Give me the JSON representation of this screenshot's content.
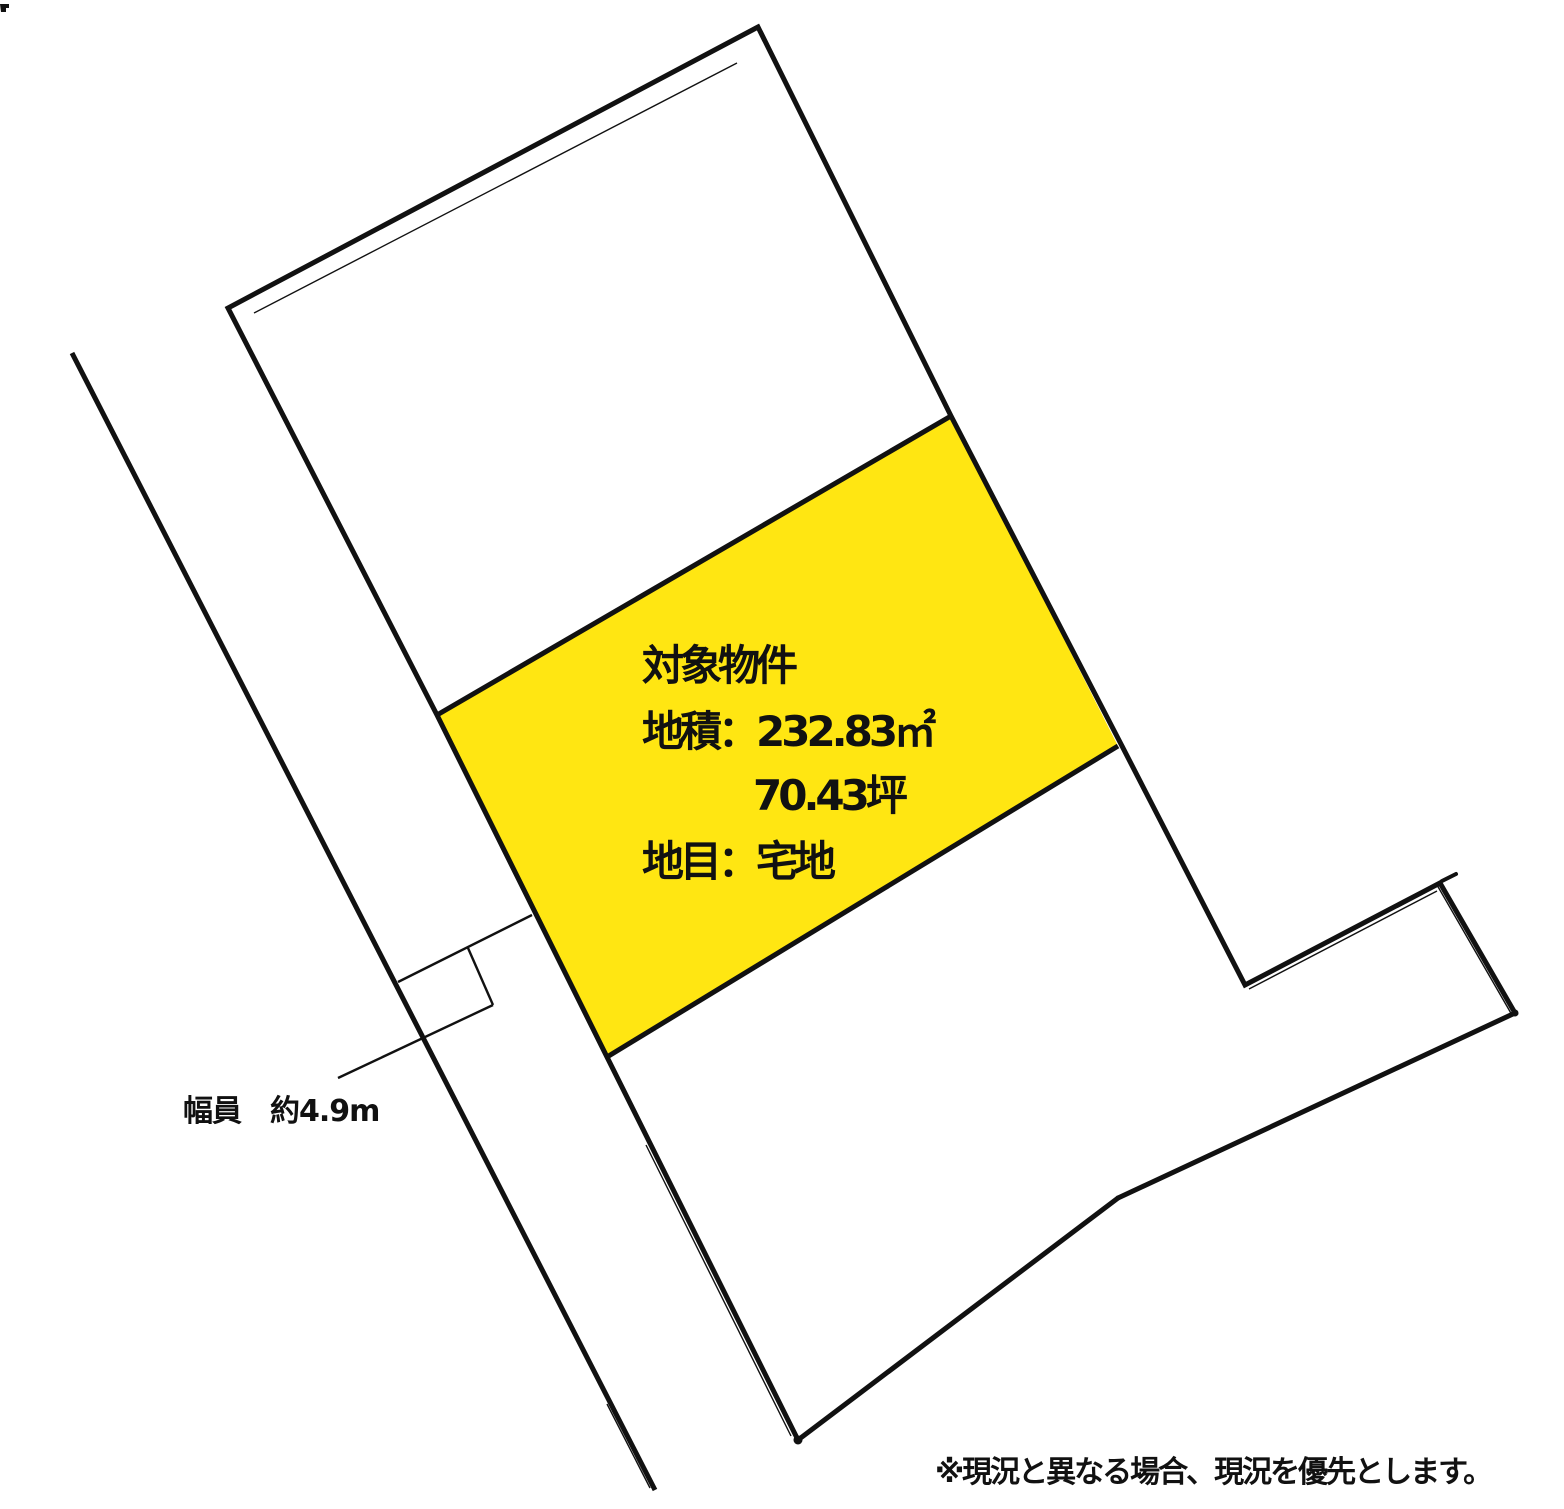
{
  "colors": {
    "highlight": "#ffe612",
    "line": "#111111",
    "text": "#111111"
  },
  "target_parcel": {
    "title": "対象物件",
    "area_sqm": "地積：232.83㎡",
    "area_tsubo": "70.43坪",
    "category": "地目：宅地"
  },
  "road": {
    "width_label": "幅員　約4.9m"
  },
  "note": "※現況と異なる場合、現況を優先とします。"
}
